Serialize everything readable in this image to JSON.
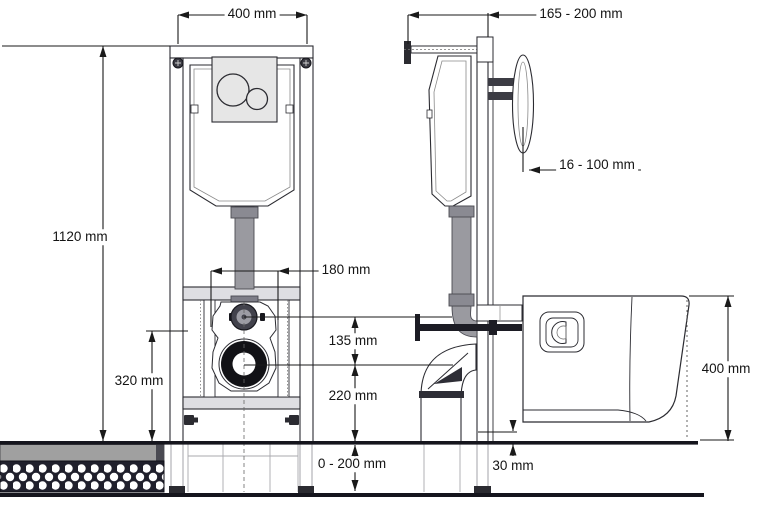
{
  "drawing_title": "Concealed cistern WC installation frame - dimension drawing",
  "dimensions": {
    "frame_width": "400 mm",
    "wall_distance": "165 - 200 mm",
    "frame_height": "1120 mm",
    "fixing_centres": "180 mm",
    "flush_to_waste": "135 mm",
    "inlet_height": "320 mm",
    "waste_height": "220 mm",
    "floor_buildup": "0 - 200 mm",
    "wall_lining": "16 - 100 mm",
    "pan_clearance": "30 mm",
    "pan_height": "400 mm"
  },
  "colors": {
    "line": "#2b2b31",
    "dim_line": "#1a1a1a",
    "pipe_gray": "#9a9aa0",
    "panel_gray": "#e6e6e6",
    "floor_dark": "#15151d",
    "grate_dark": "#20202c"
  }
}
